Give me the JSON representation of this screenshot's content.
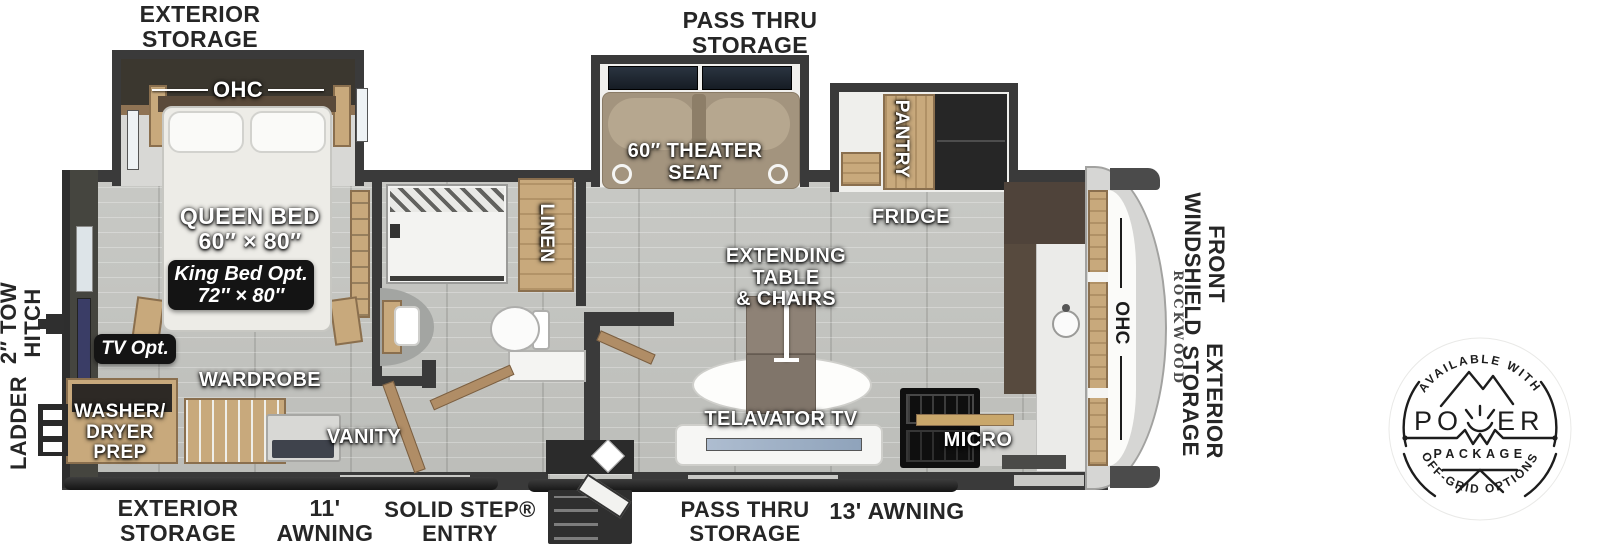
{
  "labels": {
    "exterior": {
      "top_storage": "EXTERIOR\nSTORAGE",
      "top_pass_thru": "PASS THRU\nSTORAGE",
      "bottom_storage": "EXTERIOR\nSTORAGE",
      "awning_11": "11'\nAWNING",
      "solid_step": "SOLID STEP®\nENTRY",
      "bottom_pass_thru": "PASS THRU\nSTORAGE",
      "awning_13": "13' AWNING",
      "tow_hitch": "2″ TOW\nHITCH",
      "ladder": "LADDER",
      "front_windshield": "FRONT\nWINDSHIELD",
      "front_storage": "EXTERIOR\nSTORAGE"
    },
    "interior": {
      "bedroom_ohc": "OHC",
      "queen_bed": "QUEEN BED\n60″ × 80″",
      "king_bed_opt": "King Bed Opt.\n72″ × 80″",
      "tv_opt": "TV Opt.",
      "wardrobe": "WARDROBE",
      "washer_dryer": "WASHER/\nDRYER\nPREP",
      "vanity": "VANITY",
      "linen": "LINEN",
      "theater_seat": "60″ THEATER\nSEAT",
      "pantry": "PANTRY",
      "fridge": "FRIDGE",
      "table": "EXTENDING TABLE\n& CHAIRS",
      "telavator": "TELAVATOR TV",
      "micro": "MICRO",
      "front_ohc": "OHC",
      "brand": "ROCKWOOD"
    },
    "badge": {
      "available": "AVAILABLE WITH",
      "power_left": "PO",
      "power_right": "ER",
      "package": "PACKAGE",
      "offgrid": "OFF-GRID OPTIONS"
    }
  },
  "colors": {
    "wall": "#3a3a3a",
    "wood_cabinet": "#c8a97c",
    "floor": "#c2c3bf",
    "option_box": "#141414",
    "badge_ink": "#1d1d1d"
  }
}
